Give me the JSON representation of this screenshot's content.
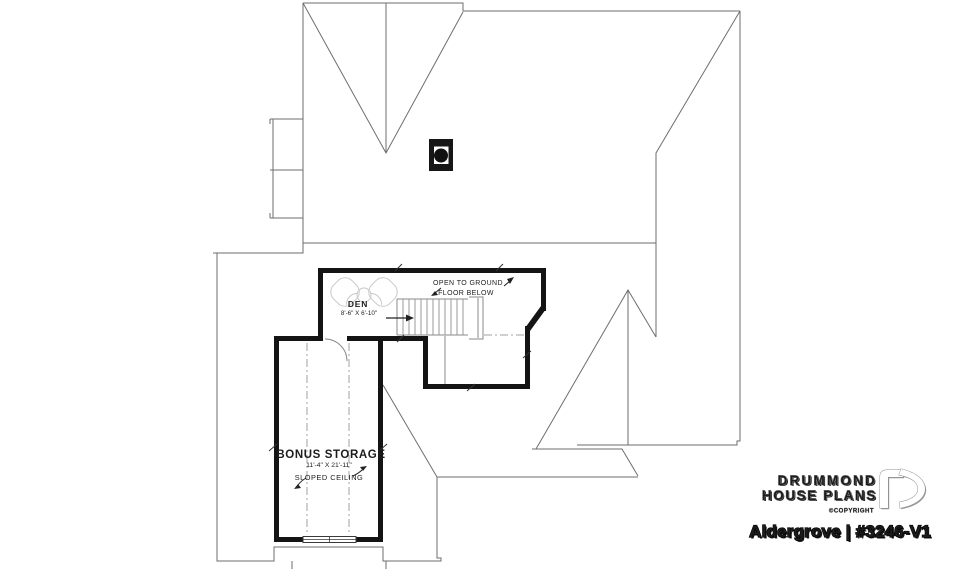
{
  "plan": {
    "open_below": {
      "line1": "OPEN TO GROUND",
      "line2": "FLOOR BELOW"
    },
    "den": {
      "name": "DEN",
      "dims": "8'-6\" X 6'-10\""
    },
    "bonus": {
      "name": "BONUS STORAGE",
      "dims": "11'-4\" X 21'-11\"",
      "note": "SLOPED CEILING"
    }
  },
  "branding": {
    "name_line1": "DRUMMOND",
    "name_line2": "HOUSE PLANS",
    "copyright_label": "©COPYRIGHT",
    "plan_title": "Aldergrove | #3246-V1"
  },
  "colors": {
    "background": "#ffffff",
    "wall": "#141414",
    "roof_line": "#6e6e6e",
    "stair_line": "#8a8a8a",
    "dashdot_line": "#a0a0a0",
    "furniture_line": "#c8c8c8",
    "label_text": "#1c1c1c",
    "logo_outline": "#8c8c8c",
    "title_outline": "#000000"
  }
}
